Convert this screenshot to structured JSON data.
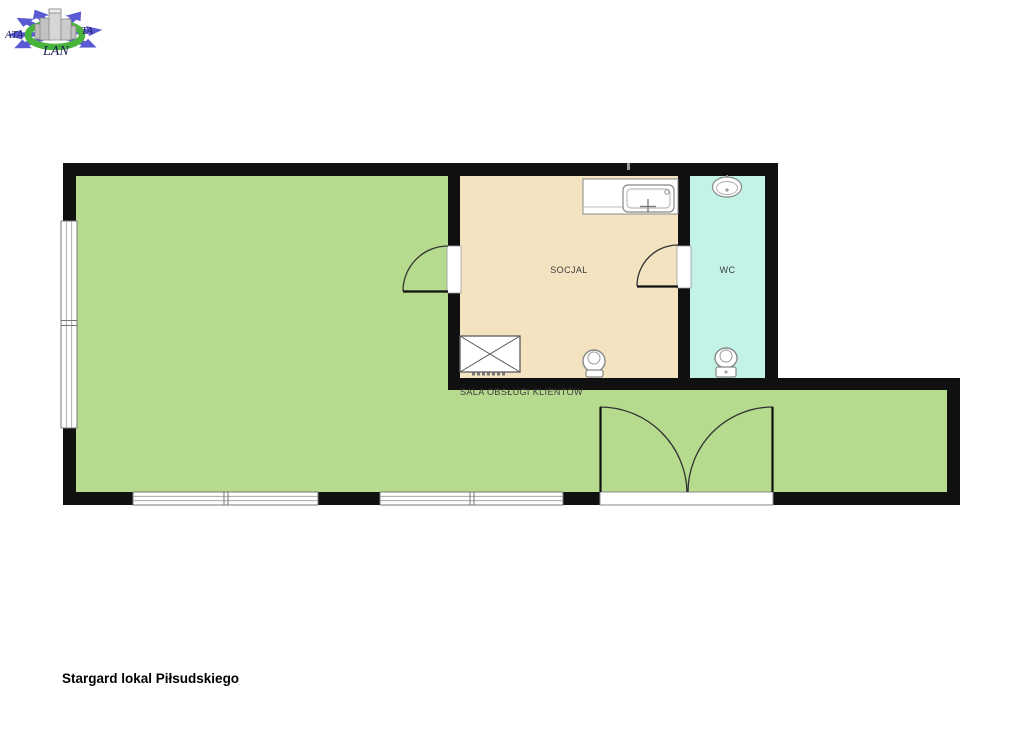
{
  "logo": {
    "brand_left": "ATA",
    "brand_right": "TA",
    "brand_bottom": "LAN",
    "colors": {
      "arrows": "#5a5ad5",
      "ring": "#49b43b",
      "buildings": "#c9c9c9",
      "text": "#1b1b55"
    }
  },
  "floorplan": {
    "wall_color": "#101010",
    "rooms": {
      "sala": {
        "label": "SALA OBSŁUGI KLIENTÓW",
        "color": "#b6db8e"
      },
      "socjal": {
        "label": "SOCJAL",
        "color": "#f4e3c1"
      },
      "wc": {
        "label": "WC",
        "color": "#c3f3e6"
      }
    },
    "fixtures": [
      "kitchen-counter",
      "kitchen-sink",
      "washbasin",
      "toilet",
      "toilet",
      "shower-tray"
    ],
    "openings": [
      "window-left",
      "window-bottom-1",
      "window-bottom-2",
      "door-socjal",
      "door-wc",
      "entrance-double-door"
    ]
  },
  "caption": "Stargard lokal Piłsudskiego"
}
